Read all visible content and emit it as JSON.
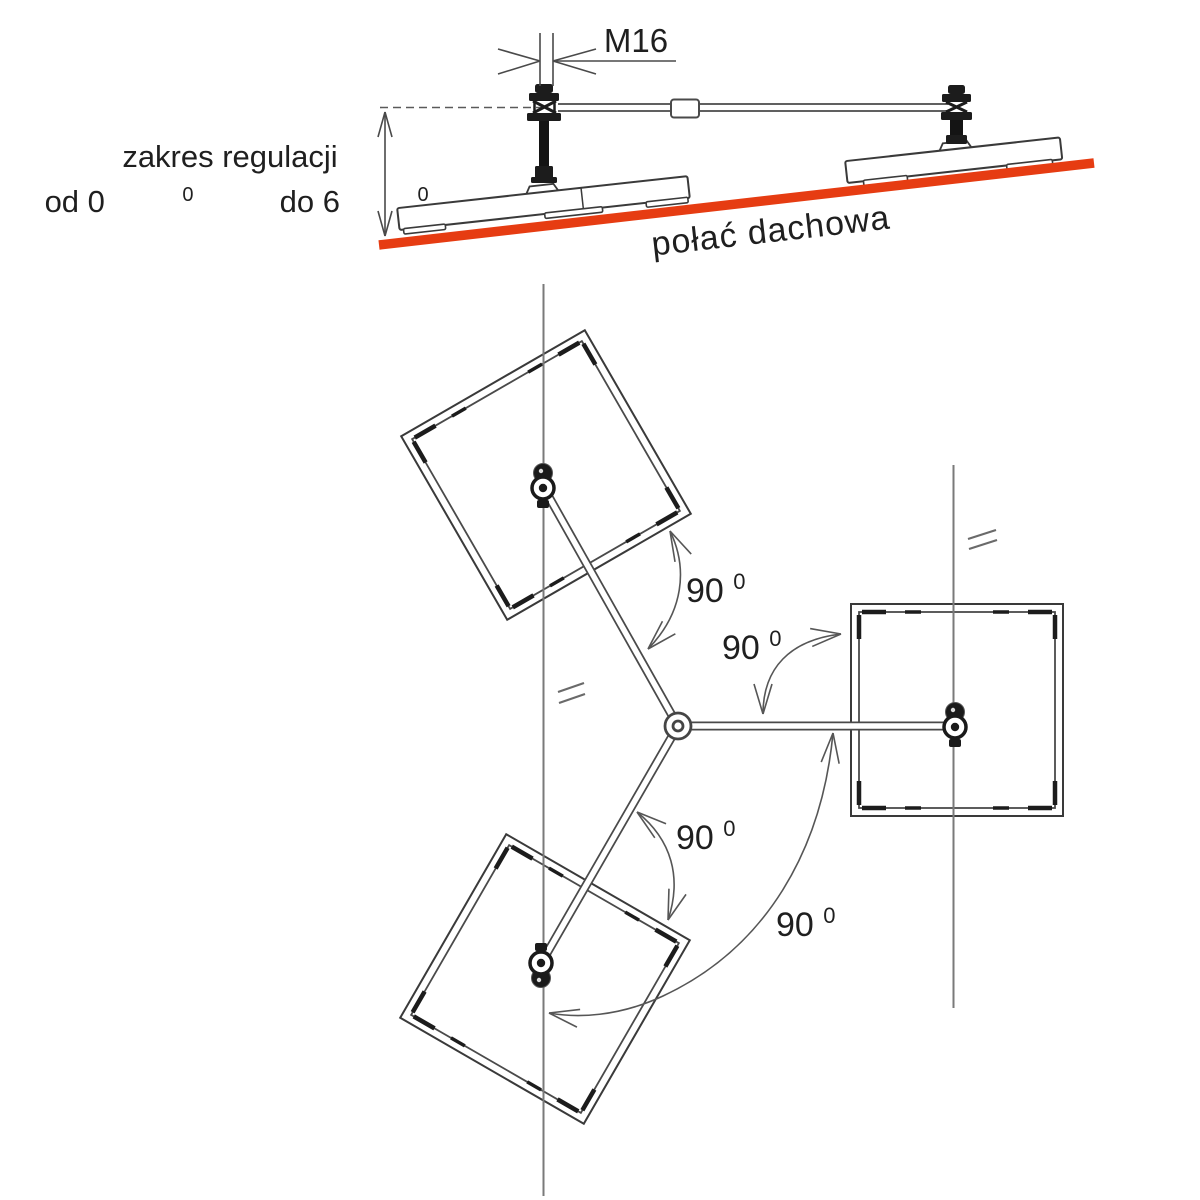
{
  "figure": {
    "side_view": {
      "m16_label": "M16",
      "range_label": {
        "line1": "zakres regulacji",
        "t1": "od 0",
        "s1": "0",
        "t2": " do 6",
        "s2": "0"
      },
      "roof_label": "połać dachowa",
      "roof_color": "#e63c12"
    },
    "plan_view": {
      "angles": [
        {
          "value": "90",
          "sup": "0"
        },
        {
          "value": "90",
          "sup": "0"
        },
        {
          "value": "90",
          "sup": "0"
        },
        {
          "value": "90",
          "sup": "0"
        }
      ]
    }
  }
}
